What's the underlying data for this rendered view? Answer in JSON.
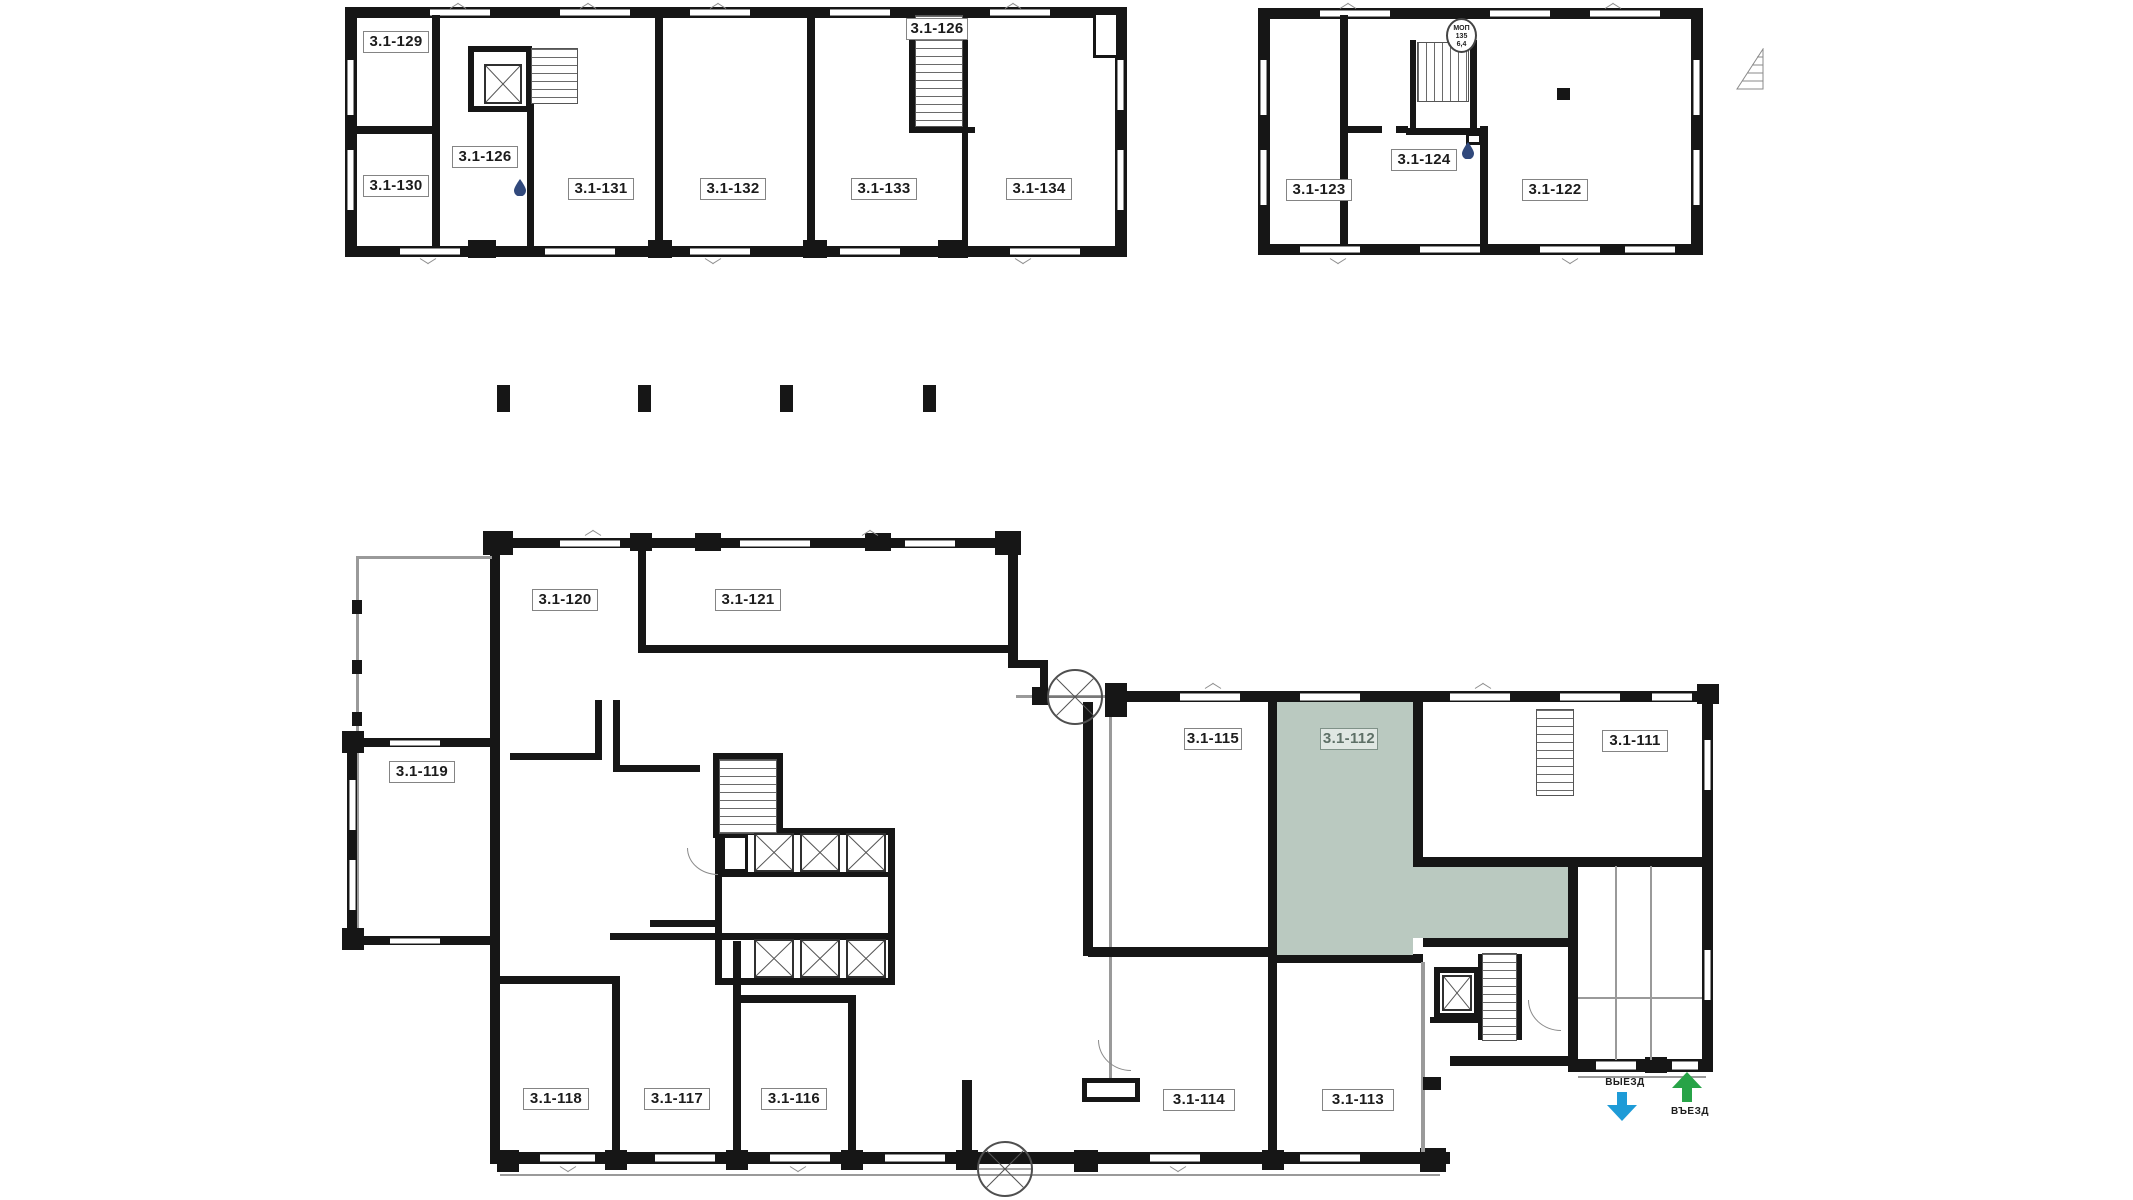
{
  "page": {
    "background": "#ffffff",
    "type": "building-floor-plan"
  },
  "rooms": {
    "r129": {
      "label": "3.1-129"
    },
    "r130": {
      "label": "3.1-130"
    },
    "r126": {
      "label": "3.1-126"
    },
    "r131": {
      "label": "3.1-131"
    },
    "r132": {
      "label": "3.1-132"
    },
    "r133": {
      "label": "3.1-133"
    },
    "r134": {
      "label": "3.1-134"
    },
    "r123": {
      "label": "3.1-123"
    },
    "r124": {
      "label": "3.1-124"
    },
    "r122": {
      "label": "3.1-122"
    },
    "r120": {
      "label": "3.1-120"
    },
    "r121": {
      "label": "3.1-121"
    },
    "r119": {
      "label": "3.1-119"
    },
    "r118": {
      "label": "3.1-118"
    },
    "r117": {
      "label": "3.1-117"
    },
    "r116": {
      "label": "3.1-116"
    },
    "r115": {
      "label": "3.1-115"
    },
    "r114": {
      "label": "3.1-114"
    },
    "r113": {
      "label": "3.1-113"
    },
    "r112": {
      "label": "3.1-112"
    },
    "r111": {
      "label": "3.1-111"
    }
  },
  "highlighted_unit": {
    "id": "3.1-112",
    "fill": "#bac9c0",
    "label_color": "#5e7067"
  },
  "stamp": {
    "line1": "МОП",
    "line2": "135",
    "line3": "6,4"
  },
  "arrows": {
    "exit": {
      "label": "ВЫЕЗД",
      "color": "#1e9bd7",
      "direction": "down"
    },
    "entrance": {
      "label": "ВЪЕЗД",
      "color": "#27a347",
      "direction": "up"
    }
  },
  "icons": {
    "water_drop_color": "#31497c"
  }
}
